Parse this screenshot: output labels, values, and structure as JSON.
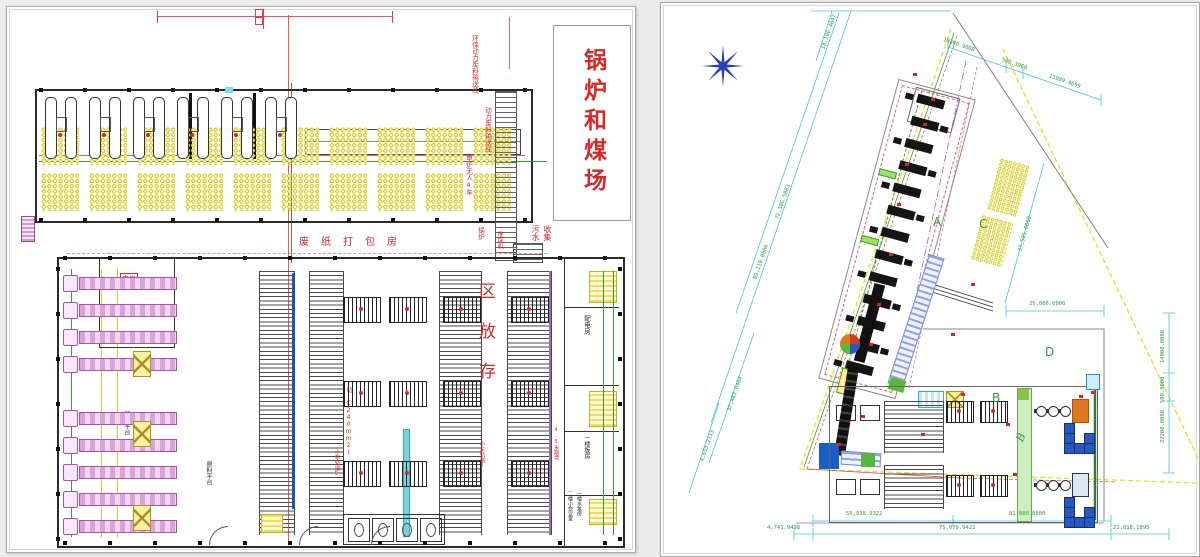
{
  "colors": {
    "cad_red": "#d42a2a",
    "dim_green": "#2e9e3e",
    "dim_cyan": "#45c8dc",
    "hatch_yellow": "#d8cd23",
    "truck_magenta": "#b050b0",
    "star_blue": "#2840b0",
    "machine_black": "#151515"
  },
  "left": {
    "boiler_coal_yard": "锅炉和煤场",
    "conveyor_labels": [
      "环保动力废料输送线",
      "动力废料输送线",
      "电炉无人4车",
      "锅炉"
    ],
    "baling_room": "废纸打包房",
    "sewage": [
      "污水",
      "收集"
    ],
    "stacker": "堆垛机",
    "storage_chars": [
      "区",
      "放",
      "存"
    ],
    "platform_unload": "卸货平台",
    "platform_material": "原料平台",
    "elec_room": "电房",
    "cable_note": "切(C240mm2)",
    "track3": "小车轨道3",
    "track5": "小车轨道5",
    "wall_note": "4.5米隔墙",
    "rooms": [
      "配电房",
      "一楼板房",
      "二楼小会议室",
      "一楼水泵房"
    ]
  },
  "right": {
    "areas": {
      "a": "A",
      "b": "B",
      "b2": "B",
      "c": "C",
      "d": "D"
    },
    "dims": {
      "top": [
        "10360.9008",
        "500.3960",
        "15900.4699"
      ],
      "left_diagonal": [
        "18,196.4647",
        "72,386.5883",
        "89,110.0006"
      ],
      "mid": [
        "37,505.0060",
        "25,006.0000"
      ],
      "right_edge": [
        "14000.0000",
        "500.0000",
        "22200.0000"
      ],
      "lower_left": [
        "37,483.6464",
        "4,653.2113"
      ],
      "bottom_upper": [
        "55,938.9322",
        "81,000.0000"
      ],
      "bottom_lower": [
        "4,741.9498",
        "75,079.9422",
        "21,818.1895"
      ]
    }
  }
}
